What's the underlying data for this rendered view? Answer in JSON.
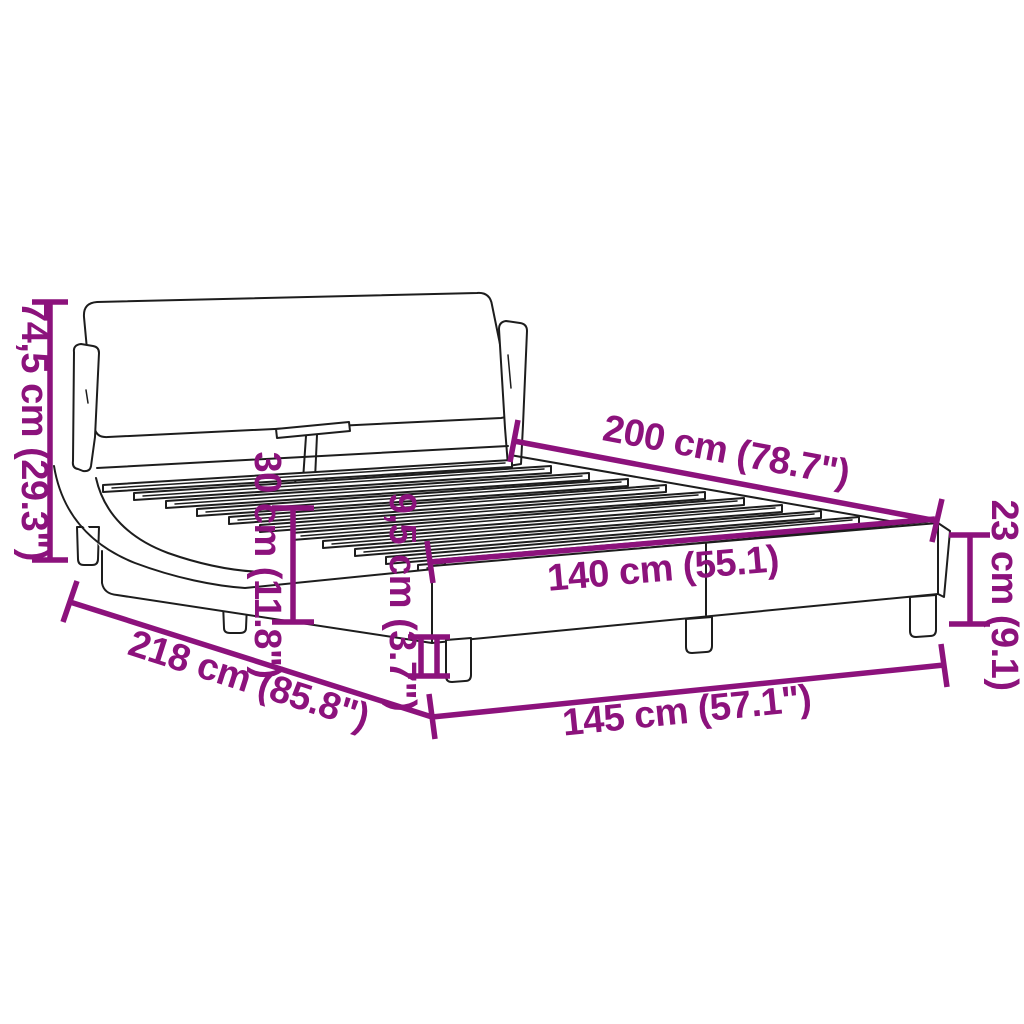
{
  "diagram": {
    "accent_color": "#8c127c",
    "line_color": "#1d1d1d",
    "background": "#ffffff"
  },
  "dimensions": {
    "overall_height": {
      "label": "74,5 cm (29.3\")"
    },
    "length_top": {
      "label": "200 cm (78.7\")"
    },
    "rail_height": {
      "label": "30 cm (11.8\")"
    },
    "leg_height": {
      "label": "9,5 cm (3.7\")"
    },
    "inner_width": {
      "label": "140 cm (55.1)"
    },
    "frame_height": {
      "label": "23 cm (9.1)"
    },
    "overall_length": {
      "label": "218 cm (85.8\")"
    },
    "overall_width": {
      "label": "145 cm (57.1\")"
    }
  }
}
